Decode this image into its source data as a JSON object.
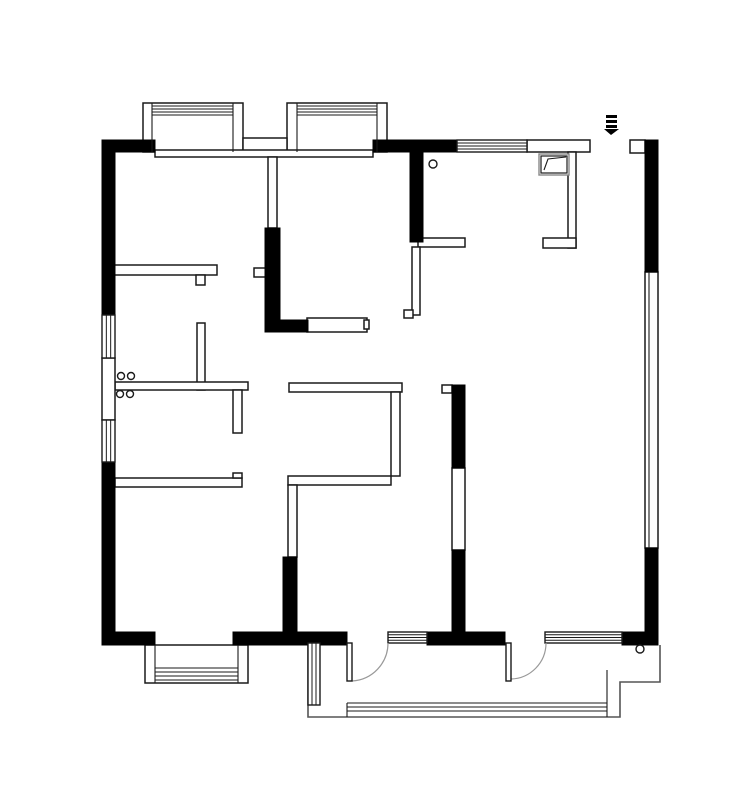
{
  "meta": {
    "title": "apartment-floor-plan",
    "canvas": {
      "width": 750,
      "height": 806
    },
    "colors": {
      "background": "#ffffff",
      "wall": "#000000",
      "line": "#1a1a1a",
      "light_line": "#555555",
      "arc": "#999999",
      "appliance_outer": "#888888"
    }
  },
  "plan": {
    "black_rects": [
      [
        102,
        140,
        13,
        175
      ],
      [
        102,
        462,
        13,
        183
      ],
      [
        102,
        140,
        53,
        12
      ],
      [
        373,
        140,
        84,
        12
      ],
      [
        410,
        140,
        13,
        102
      ],
      [
        645,
        140,
        13,
        132
      ],
      [
        645,
        548,
        13,
        97
      ],
      [
        102,
        632,
        53,
        13
      ],
      [
        233,
        632,
        114,
        13
      ],
      [
        427,
        632,
        78,
        13
      ],
      [
        622,
        632,
        36,
        13
      ],
      [
        265,
        228,
        15,
        92
      ],
      [
        265,
        320,
        43,
        12
      ],
      [
        452,
        385,
        13,
        83
      ],
      [
        452,
        550,
        13,
        82
      ],
      [
        283,
        557,
        14,
        75
      ]
    ],
    "thin_walls": [
      [
        155,
        150,
        218,
        7
      ],
      [
        268,
        157,
        9,
        71
      ],
      [
        113,
        265,
        104,
        10
      ],
      [
        196,
        275,
        9,
        10
      ],
      [
        197,
        323,
        8,
        67
      ],
      [
        115,
        382,
        133,
        8
      ],
      [
        233,
        390,
        9,
        43
      ],
      [
        115,
        478,
        127,
        9
      ],
      [
        233,
        473,
        9,
        5
      ],
      [
        289,
        383,
        113,
        9
      ],
      [
        391,
        392,
        9,
        84
      ],
      [
        288,
        476,
        103,
        9
      ],
      [
        288,
        485,
        9,
        72
      ],
      [
        418,
        238,
        47,
        9
      ],
      [
        412,
        247,
        8,
        68
      ],
      [
        404,
        310,
        9,
        8
      ],
      [
        527,
        140,
        63,
        12
      ],
      [
        568,
        152,
        8,
        96
      ],
      [
        543,
        238,
        33,
        10
      ],
      [
        630,
        140,
        15,
        13
      ],
      [
        442,
        385,
        10,
        8
      ],
      [
        307,
        318,
        60,
        14
      ],
      [
        364,
        320,
        5,
        9
      ],
      [
        254,
        268,
        12,
        9
      ],
      [
        102,
        358,
        13,
        62
      ]
    ],
    "outline_rects": [
      [
        143,
        103,
        100,
        49
      ],
      [
        287,
        103,
        100,
        49
      ],
      [
        243,
        138,
        44,
        14
      ],
      [
        145,
        645,
        103,
        38
      ],
      [
        645,
        272,
        13,
        276
      ],
      [
        452,
        468,
        13,
        82
      ]
    ],
    "windows_h": [
      {
        "x": 457,
        "y": 140,
        "w": 70,
        "h": 12,
        "lines": 3
      },
      {
        "x": 388,
        "y": 632,
        "w": 39,
        "h": 11,
        "lines": 3
      },
      {
        "x": 545,
        "y": 632,
        "w": 77,
        "h": 11,
        "lines": 3
      }
    ],
    "windows_v": [
      {
        "x": 102,
        "y": 315,
        "w": 13,
        "h": 43,
        "lines": 2
      },
      {
        "x": 102,
        "y": 420,
        "w": 13,
        "h": 42,
        "lines": 2
      },
      {
        "x": 308,
        "y": 643,
        "w": 12,
        "h": 62,
        "lines": 2
      }
    ],
    "lines": [
      [
        152,
        103,
        152,
        152
      ],
      [
        233,
        103,
        233,
        152
      ],
      [
        152,
        106,
        233,
        106
      ],
      [
        152,
        109,
        233,
        109
      ],
      [
        152,
        112,
        233,
        112
      ],
      [
        152,
        115,
        233,
        115
      ],
      [
        297,
        103,
        297,
        152
      ],
      [
        377,
        103,
        377,
        152
      ],
      [
        297,
        106,
        377,
        106
      ],
      [
        297,
        109,
        377,
        109
      ],
      [
        297,
        112,
        377,
        112
      ],
      [
        297,
        115,
        377,
        115
      ],
      [
        155,
        645,
        155,
        683
      ],
      [
        238,
        645,
        238,
        683
      ],
      [
        155,
        668,
        238,
        668
      ],
      [
        155,
        672,
        238,
        672
      ],
      [
        155,
        676,
        238,
        676
      ],
      [
        155,
        680,
        238,
        680
      ],
      [
        649,
        272,
        649,
        548
      ],
      [
        347,
        703,
        607,
        703
      ],
      [
        347,
        707,
        607,
        707
      ],
      [
        347,
        711,
        607,
        711
      ],
      [
        347,
        703,
        347,
        717
      ],
      [
        607,
        670,
        607,
        717
      ]
    ],
    "polylines": [
      {
        "points": [
          [
            308,
            643
          ],
          [
            308,
            717
          ],
          [
            620,
            717
          ],
          [
            620,
            682
          ],
          [
            660,
            682
          ],
          [
            660,
            645
          ]
        ]
      }
    ],
    "doors": [
      {
        "leaf": [
          347,
          643,
          5,
          38
        ],
        "arc": "M388,643 A38,38 0 0 1 352,681"
      },
      {
        "leaf": [
          506,
          643,
          5,
          38
        ],
        "arc": "M546,643 A36,36 0 0 1 511,679"
      }
    ],
    "circles": [
      [
        433,
        164,
        4
      ],
      [
        640,
        649,
        4
      ],
      [
        121,
        376,
        3.5
      ],
      [
        131,
        376,
        3.5
      ],
      [
        120,
        394,
        3.5
      ],
      [
        130,
        394,
        3.5
      ]
    ],
    "entry_arrow": {
      "bars": [
        [
          606,
          115,
          11,
          3
        ],
        [
          606,
          120,
          11,
          3
        ],
        [
          606,
          125,
          11,
          3
        ]
      ],
      "triangle": [
        [
          604,
          129
        ],
        [
          619,
          129
        ],
        [
          611,
          135
        ]
      ]
    },
    "appliance": {
      "outer": [
        539,
        154,
        30,
        21
      ],
      "inner": [
        541,
        156,
        26,
        17
      ],
      "flap": [
        [
          544,
          170
        ],
        [
          548,
          159
        ],
        [
          566,
          157
        ]
      ]
    }
  }
}
